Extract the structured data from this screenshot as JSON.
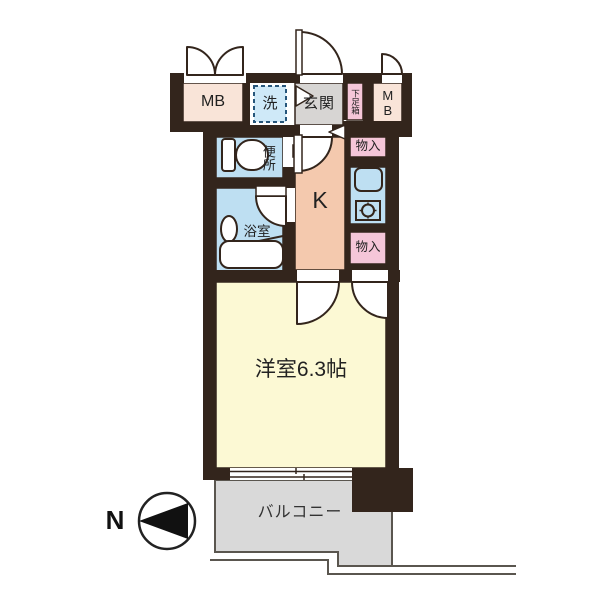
{
  "floorplan": {
    "title": "1K apartment floor plan",
    "labels": {
      "mb_left": "MB",
      "laundry": "洗",
      "entrance": "玄関",
      "shoe_box": "下足箱",
      "mb_right": "MB",
      "toilet": "便所",
      "bathroom": "浴室",
      "kitchen": "K",
      "storage_top": "物入",
      "storage_bottom": "物入",
      "main_room": "洋室6.3帖",
      "balcony": "バルコニー",
      "north": "N"
    },
    "icons": [
      "toilet-icon",
      "washbasin-icon",
      "bathtub-icon",
      "washing-machine-pan-icon",
      "kitchen-sink-icon",
      "stove-burner-icon",
      "door-swing-arc-icon",
      "step-arrow-icon",
      "north-compass-icon"
    ],
    "colors": {
      "wall": "#33251c",
      "room_yellow": "#fcf9d4",
      "kitchen_peach": "#f4c9ae",
      "water_blue": "#bedff2",
      "laundry_blue": "#cfe9f8",
      "storage_pink": "#f5c6d8",
      "mb_beige": "#f9e4d8",
      "entrance_gray": "#d7d5d3",
      "balcony_gray": "#d9d9d9",
      "outline_thin": "#5a564f"
    }
  }
}
